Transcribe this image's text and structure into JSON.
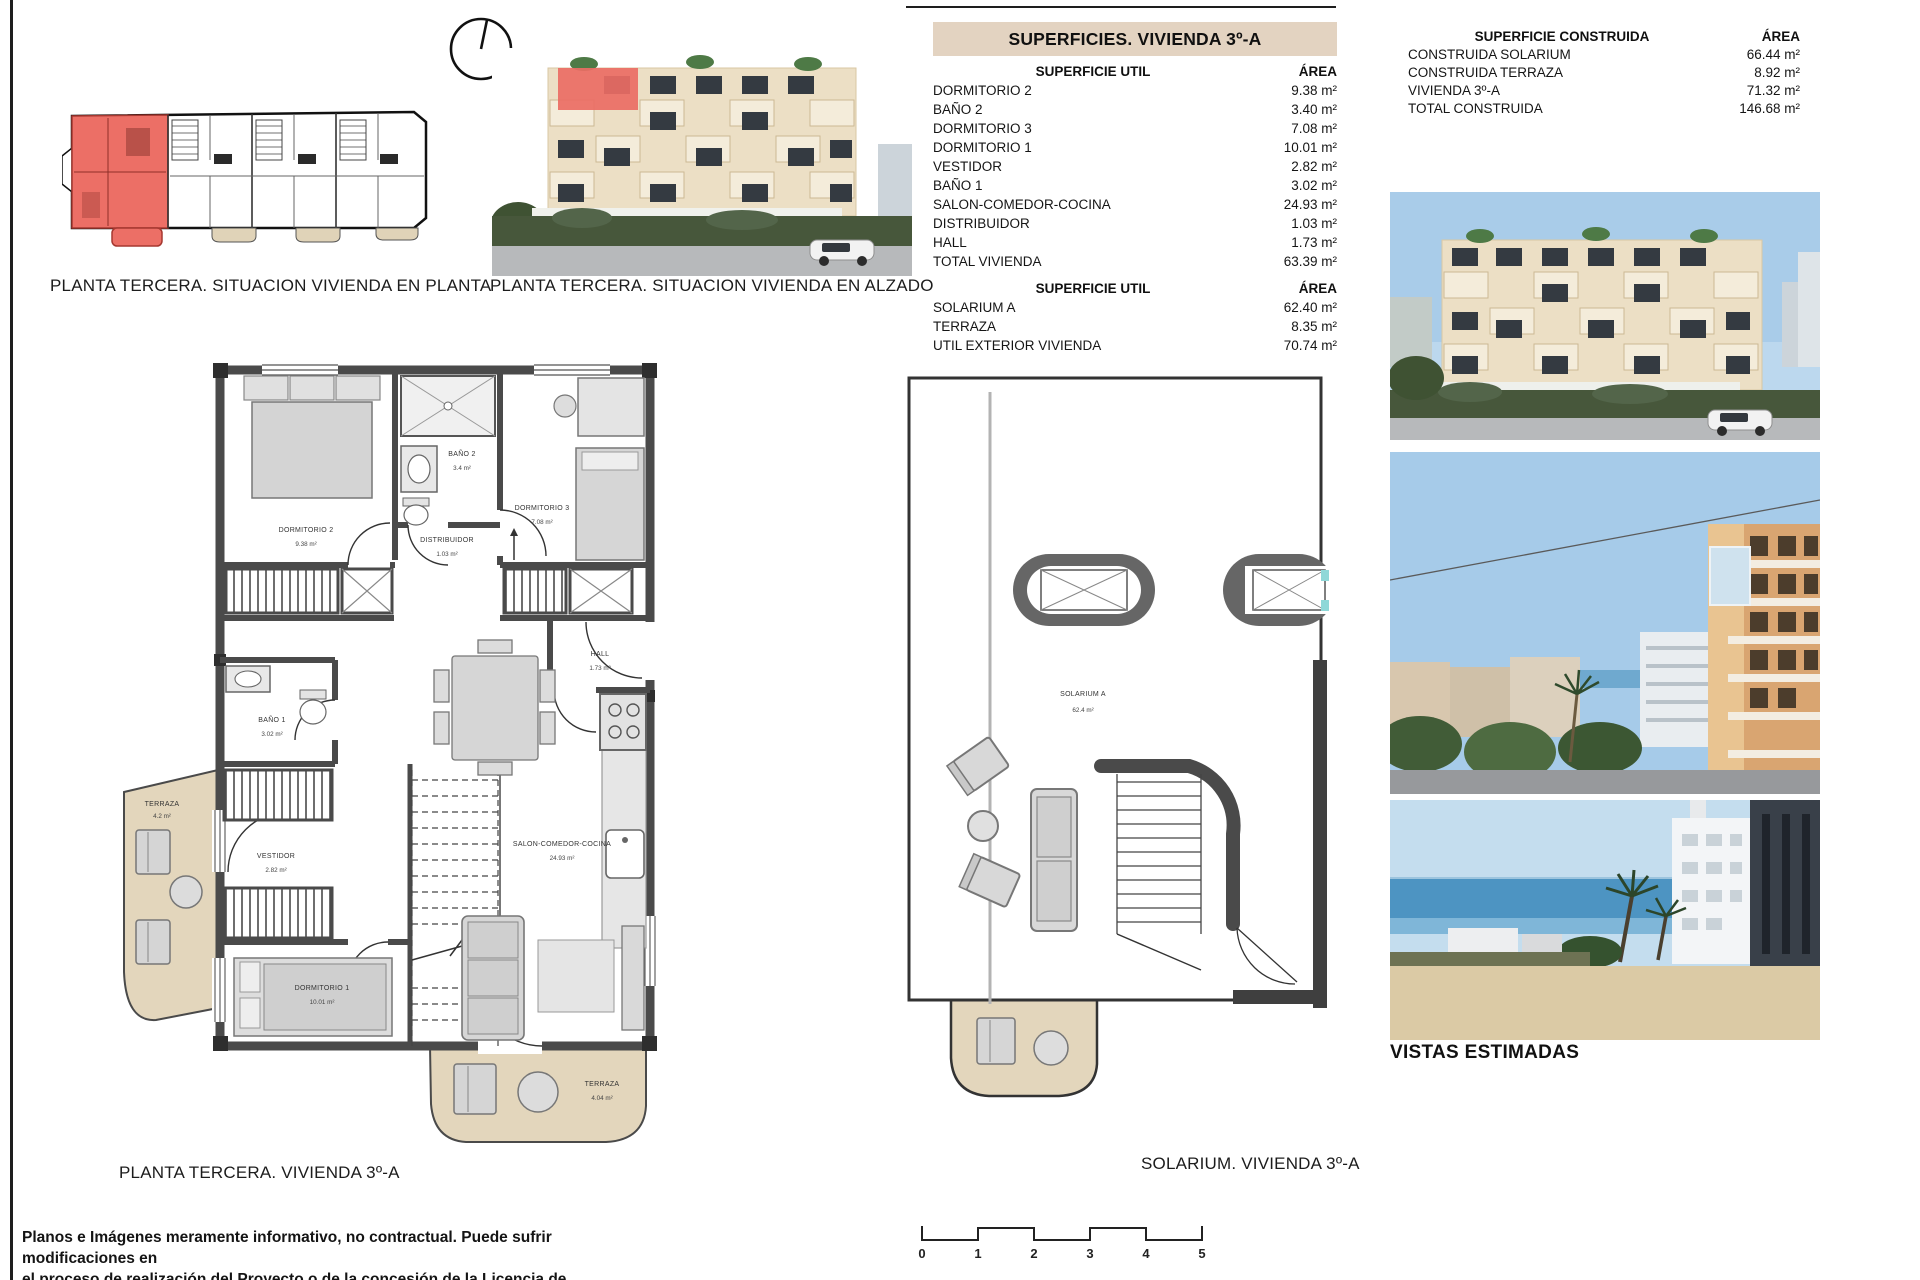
{
  "page": {
    "disclaimer_line1": "Planos e Imágenes meramente informativo, no contractual. Puede sufrir modificaciones en",
    "disclaimer_line2": "el proceso de realización del Proyecto o de la concesión de la Licencia de Construcción."
  },
  "captions": {
    "situacion_planta": "PLANTA TERCERA. SITUACION VIVIENDA EN PLANTA",
    "situacion_alzado": "PLANTA TERCERA. SITUACION VIVIENDA EN ALZADO",
    "floor_plan": "PLANTA  TERCERA. VIVIENDA 3º-A",
    "solarium": "SOLARIUM. VIVIENDA 3º-A",
    "vistas": "VISTAS ESTIMADAS"
  },
  "superficies": {
    "title": "SUPERFICIES. VIVIENDA 3º-A",
    "util": {
      "header_label": "SUPERFICIE UTIL",
      "header_area": "ÁREA",
      "rows": [
        {
          "label": "DORMITORIO 2",
          "area": "9.38 m²"
        },
        {
          "label": "BAÑO 2",
          "area": "3.40 m²"
        },
        {
          "label": "DORMITORIO 3",
          "area": "7.08 m²"
        },
        {
          "label": "DORMITORIO 1",
          "area": "10.01 m²"
        },
        {
          "label": "VESTIDOR",
          "area": "2.82 m²"
        },
        {
          "label": "BAÑO 1",
          "area": "3.02 m²"
        },
        {
          "label": "SALON-COMEDOR-COCINA",
          "area": "24.93 m²"
        },
        {
          "label": "DISTRIBUIDOR",
          "area": "1.03 m²"
        },
        {
          "label": "HALL",
          "area": "1.73 m²"
        },
        {
          "label": "TOTAL VIVIENDA",
          "area": "63.39 m²"
        }
      ]
    },
    "exterior": {
      "header_label": "SUPERFICIE UTIL",
      "header_area": "ÁREA",
      "rows": [
        {
          "label": "SOLARIUM A",
          "area": "62.40 m²"
        },
        {
          "label": "TERRAZA",
          "area": "8.35 m²"
        },
        {
          "label": "UTIL EXTERIOR VIVIENDA",
          "area": "70.74 m²"
        }
      ]
    }
  },
  "construida": {
    "header_label": "SUPERFICIE CONSTRUIDA",
    "header_area": "ÁREA",
    "rows": [
      {
        "label": "CONSTRUIDA SOLARIUM",
        "area": "66.44 m²"
      },
      {
        "label": "CONSTRUIDA TERRAZA",
        "area": "8.92 m²"
      },
      {
        "label": "VIVIENDA 3º-A",
        "area": "71.32 m²"
      },
      {
        "label": "TOTAL CONSTRUIDA",
        "area": "146.68 m²"
      }
    ]
  },
  "floor_plan": {
    "rooms": [
      {
        "name": "DORMITORIO 2",
        "area": "9.38 m²"
      },
      {
        "name": "BAÑO 2",
        "area": "3.4 m²"
      },
      {
        "name": "DORMITORIO 3",
        "area": "7.08 m²"
      },
      {
        "name": "DISTRIBUIDOR",
        "area": "1.03 m²"
      },
      {
        "name": "HALL",
        "area": "1.73 m²"
      },
      {
        "name": "BAÑO 1",
        "area": "3.02 m²"
      },
      {
        "name": "VESTIDOR",
        "area": "2.82 m²"
      },
      {
        "name": "DORMITORIO 1",
        "area": "10.01 m²"
      },
      {
        "name": "SALON-COMEDOR-COCINA",
        "area": "24.93 m²"
      },
      {
        "name": "TERRAZA",
        "area": "4.2 m²"
      },
      {
        "name": "TERRAZA",
        "area": "4.04 m²"
      }
    ]
  },
  "solarium_plan": {
    "room_name": "SOLARIUM A",
    "room_area": "62.4 m²"
  },
  "scale_bar": {
    "ticks": [
      "0",
      "1",
      "2",
      "3",
      "4",
      "5"
    ]
  },
  "colors": {
    "highlight_red": "#ea6d64",
    "banner_tan": "#e3d3c1",
    "terrace_beige": "#e3d6bc",
    "wall_gray": "#4a4a4a"
  }
}
